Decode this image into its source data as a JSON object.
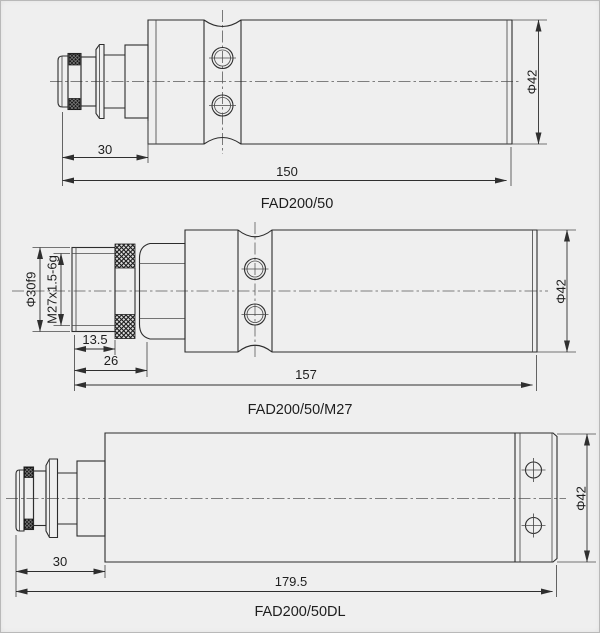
{
  "page": {
    "background": "#efefef",
    "line_color": "#2d2d2d",
    "dim_color": "#2f2f2f"
  },
  "drawings": {
    "fad200_50": {
      "label": "FAD200/50",
      "dims": {
        "front_length": "30",
        "total_length": "150",
        "diameter": "Φ42"
      }
    },
    "fad200_50_m27": {
      "label": "FAD200/50/M27",
      "dims": {
        "thread_od": "Φ30f9",
        "thread_spec": "M27x1.5-6g",
        "thread_length": "13.5",
        "front_length": "26",
        "total_length": "157",
        "diameter": "Φ42"
      }
    },
    "fad200_50_dl": {
      "label": "FAD200/50DL",
      "dims": {
        "front_length": "30",
        "total_length": "179.5",
        "diameter": "Φ42"
      }
    }
  }
}
